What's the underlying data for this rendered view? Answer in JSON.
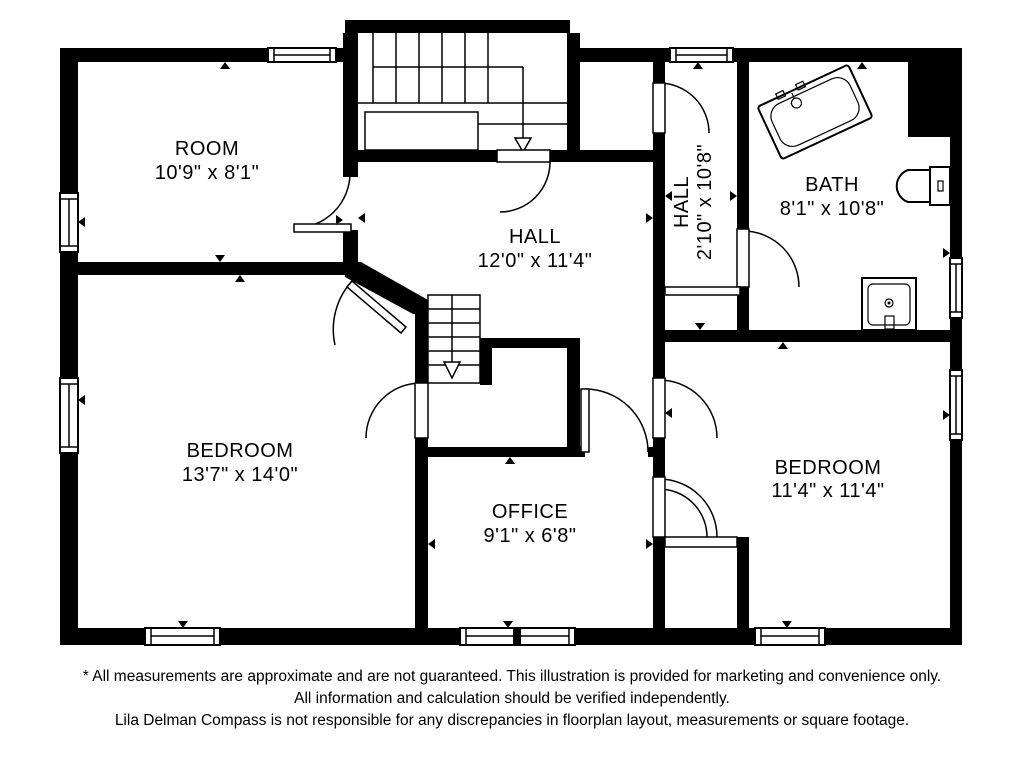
{
  "plan": {
    "rooms": [
      {
        "id": "room",
        "name": "ROOM",
        "dims": "10'9\" x 8'1\""
      },
      {
        "id": "hall-main",
        "name": "HALL",
        "dims": "12'0\" x 11'4\""
      },
      {
        "id": "hall-upper",
        "name": "HALL",
        "dims": "2'10\" x 10'8\""
      },
      {
        "id": "bath",
        "name": "BATH",
        "dims": "8'1\" x 10'8\""
      },
      {
        "id": "bedroom-left",
        "name": "BEDROOM",
        "dims": "13'7\" x 14'0\""
      },
      {
        "id": "office",
        "name": "OFFICE",
        "dims": "9'1\" x 6'8\""
      },
      {
        "id": "bedroom-right",
        "name": "BEDROOM",
        "dims": "11'4\" x 11'4\""
      }
    ],
    "fixtures": [
      "bathtub",
      "toilet",
      "sink",
      "staircase-upper",
      "staircase-lower"
    ],
    "colors": {
      "wall": "#000000",
      "background": "#ffffff",
      "fixture_line": "#000000"
    }
  },
  "disclaimer": {
    "line1": "* All measurements are approximate and are not guaranteed. This illustration is provided for marketing and convenience only.",
    "line2": "All information and calculation should be verified independently.",
    "line3": "Lila Delman Compass  is not responsible for any discrepancies in floorplan layout, measurements or square footage."
  }
}
